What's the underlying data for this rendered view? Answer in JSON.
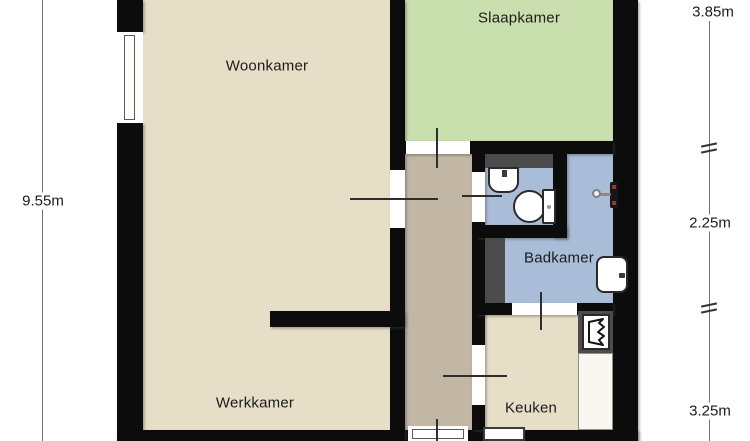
{
  "rooms": {
    "woonkamer": {
      "label": "Woonkamer",
      "color": "#e6dec6"
    },
    "slaapkamer": {
      "label": "Slaapkamer",
      "color": "#c9dfad"
    },
    "badkamer": {
      "label": "Badkamer",
      "color": "#a9bcd8"
    },
    "werkkamer": {
      "label": "Werkkamer",
      "color": "#e6dec6"
    },
    "keuken": {
      "label": "Keuken",
      "color": "#e6dec6"
    },
    "hall": {
      "label": "",
      "color": "#c2b6a4"
    },
    "wc": {
      "label": "",
      "color": "#a9bcd8"
    }
  },
  "dimensions": {
    "left": {
      "total": "9.55m"
    },
    "right": {
      "top": "3.85m",
      "middle": "2.25m",
      "bottom": "3.25m"
    }
  },
  "fixtures": {
    "wc": [
      "sink-icon",
      "toilet-icon"
    ],
    "badkamer": [
      "shower-mixer-icon",
      "sink-icon"
    ],
    "keuken": [
      "boiler-icon",
      "counter",
      "appliance"
    ]
  },
  "colors": {
    "floor-beige": "#e6dec6",
    "floor-green": "#c9dfad",
    "floor-blue": "#a9bcd8",
    "floor-hall": "#c2b6a4",
    "wall": "#0c0c0c",
    "shaft": "#4c4c4c",
    "counter": "#f9f7ef",
    "dim-line": "#707070",
    "text": "#1c1c1c"
  }
}
